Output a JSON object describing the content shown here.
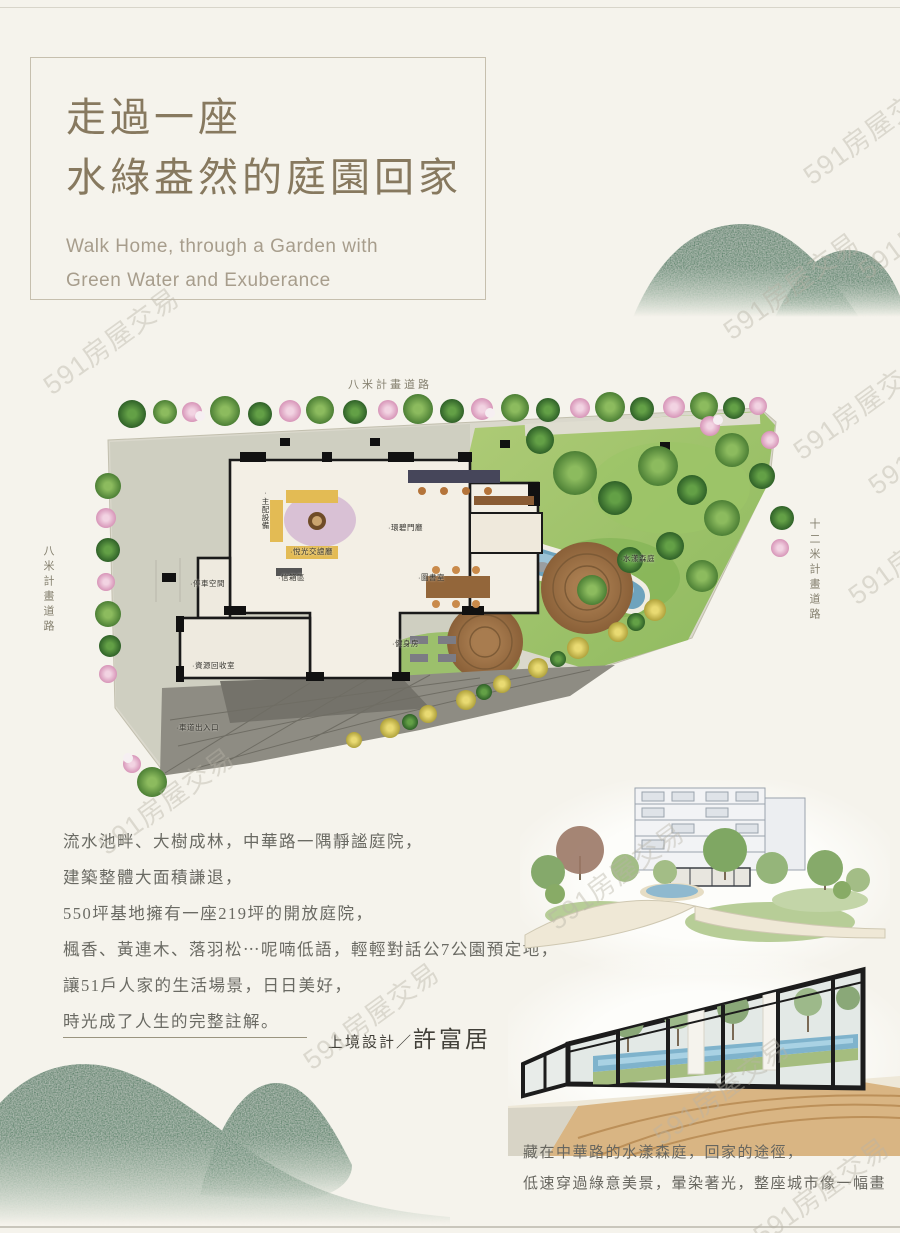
{
  "page": {
    "watermark": "591房屋交易"
  },
  "header": {
    "title_line1": "走過一座",
    "title_line2": "水綠盎然的庭園回家",
    "subtitle_line1": "Walk Home, through a Garden with",
    "subtitle_line2": "Green Water and Exuberance"
  },
  "site_plan": {
    "road_top": "八米計畫道路",
    "road_left": "八米計畫道路",
    "road_right": "十二米計畫道路",
    "labels": [
      "·主配設備",
      "·悅光交誼廳",
      "·環碧門廳",
      "·停車空間",
      "·信箱區",
      "·圖書室",
      "·水漾森庭",
      "·資源回收室",
      "·健身房",
      "·車道出入口"
    ]
  },
  "description": {
    "lines": [
      "流水池畔、大樹成林，中華路一隅靜謐庭院，",
      "建築整體大面積謙退，",
      "550坪基地擁有一座219坪的開放庭院，",
      "楓香、黃連木、落羽松⋯呢喃低語，輕輕對話公7公園預定地，",
      "讓51戶人家的生活場景，日日美好，",
      "時光成了人生的完整註解。"
    ]
  },
  "designer": {
    "prefix": "上境設計／",
    "name": "許富居"
  },
  "caption": {
    "lines": [
      "藏在中華路的水漾森庭，回家的途徑，",
      "低速穿過綠意美景，暈染著光，整座城市像一幅畫"
    ]
  },
  "colors": {
    "hill_green": "#1d6a46",
    "title_brown": "#87795f",
    "water_blue": "#6ea3bd"
  }
}
